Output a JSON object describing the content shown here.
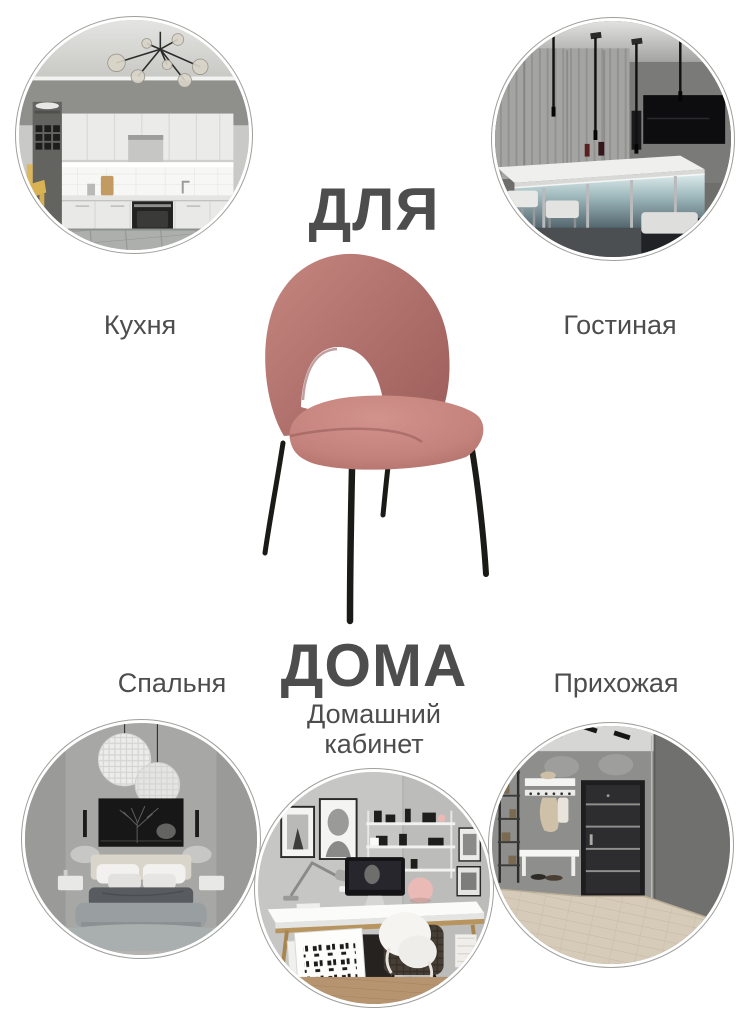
{
  "banner": {
    "title_top": "ДЛЯ",
    "title_bottom": "ДОМА",
    "text_color": "#4d4d4d",
    "background": "#ffffff"
  },
  "rooms": [
    {
      "id": "kitchen",
      "label": "Кухня",
      "photo": "light kitchen with chandelier, white cabinets, black oven, tiled floor"
    },
    {
      "id": "living-room",
      "label": "Гостиная",
      "photo": "dark living room with illuminated bar counter, stools and pendant lights"
    },
    {
      "id": "bedroom",
      "label": "Спальня",
      "photo": "gray bedroom with two sphere pendant lamps and dark picture above bed"
    },
    {
      "id": "home-office",
      "label": "Домашний кабинет",
      "photo": "home office with white desk, computer, shelves and fur-covered chair"
    },
    {
      "id": "hallway",
      "label": "Прихожая",
      "photo": "hallway with dark entrance door, coat rack, white bench, wooden floor"
    }
  ],
  "product": {
    "description": "rose velvet chair with cut-out backrest on black metal legs",
    "upholstery_color": "#b8736f",
    "legs_color": "#1a1a17"
  }
}
